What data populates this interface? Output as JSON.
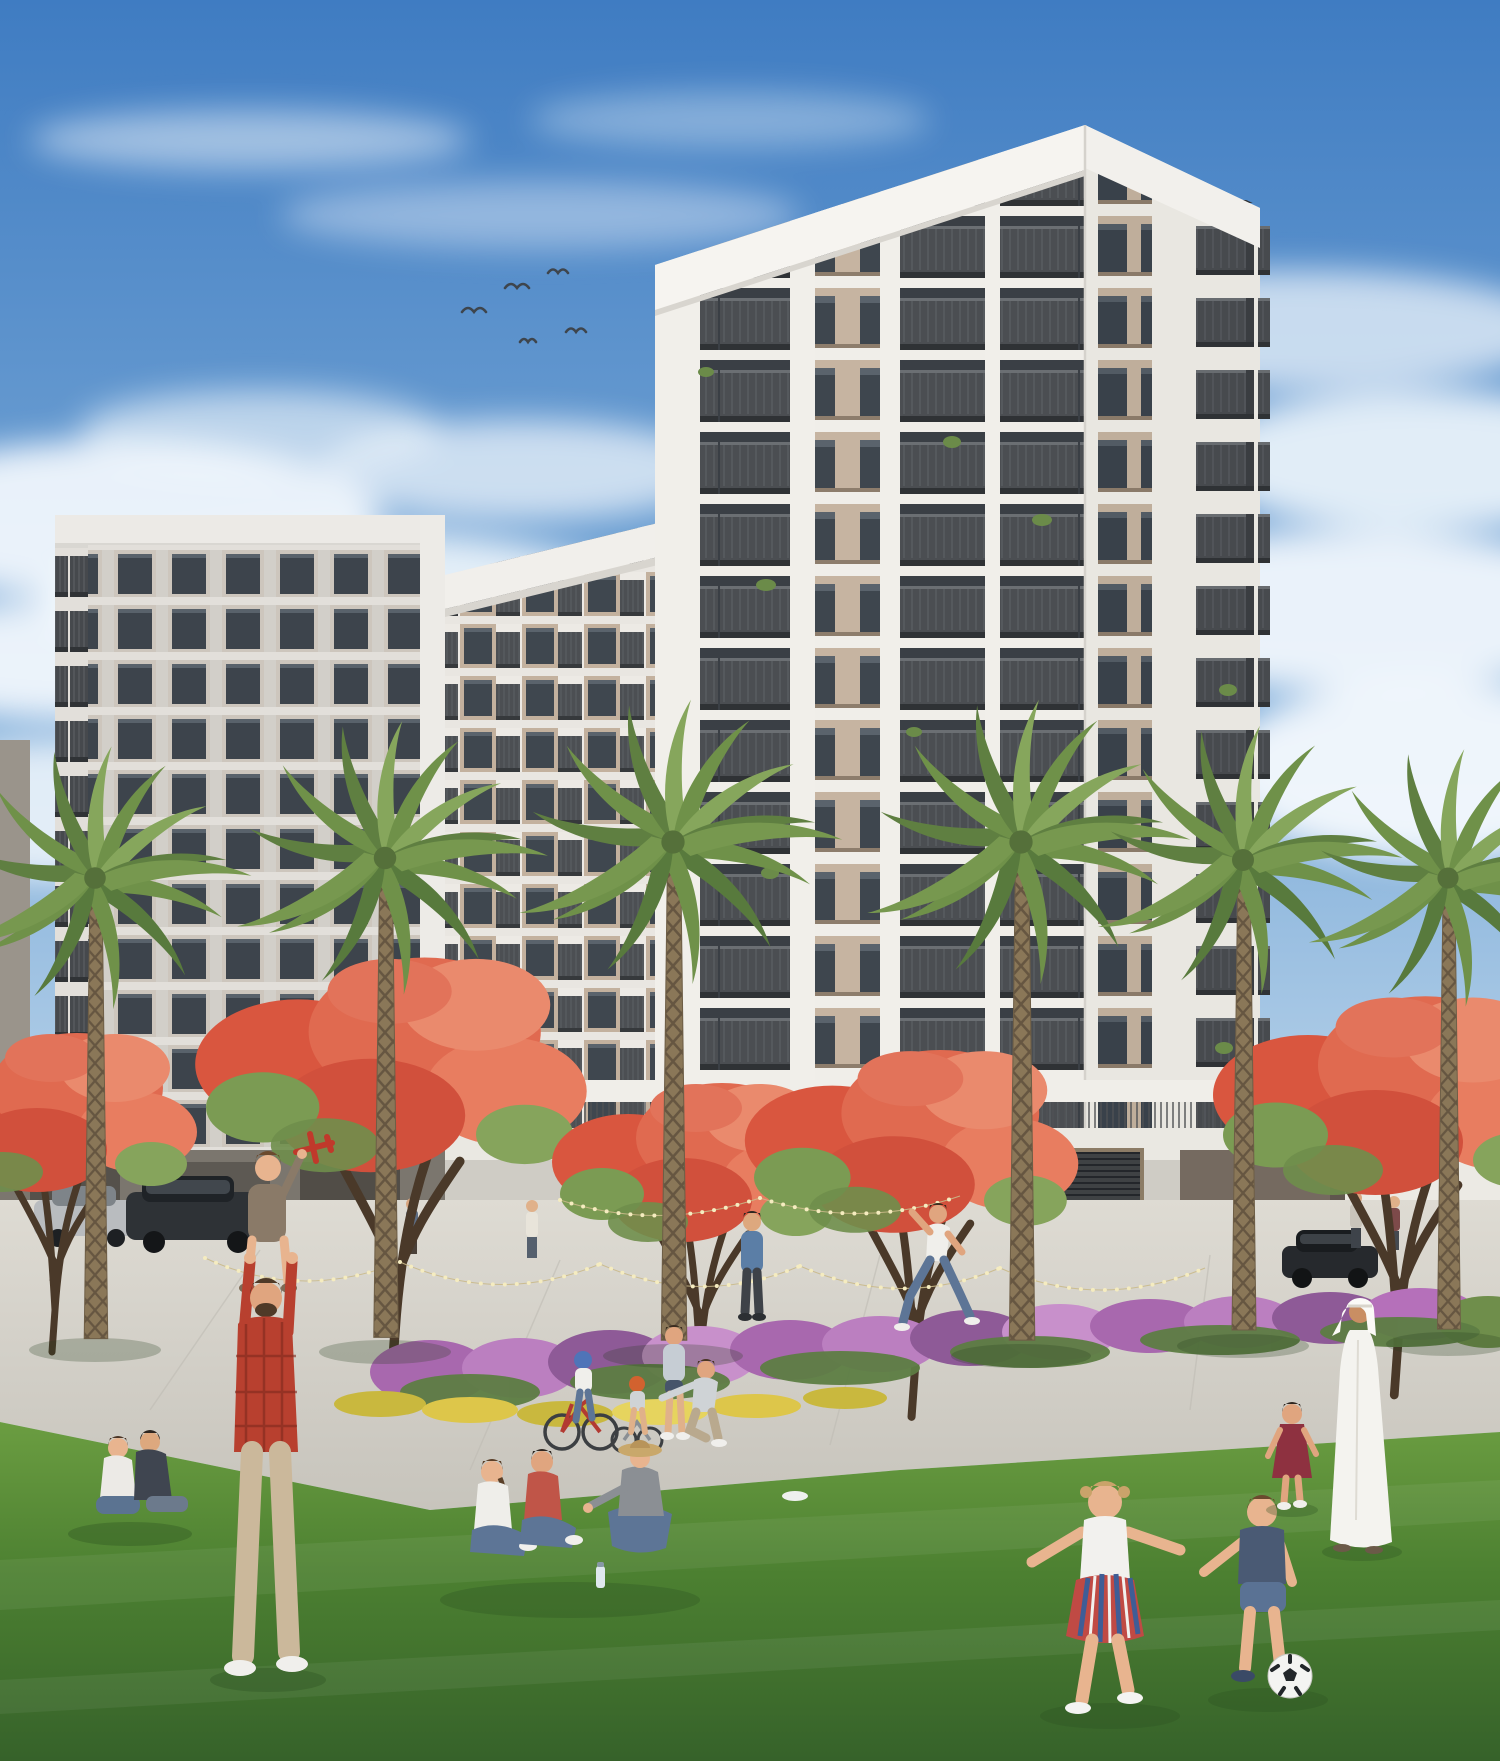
{
  "scene": {
    "type": "architectural-exterior-rendering",
    "subject": "White residential apartment complex with landscaped park promenade on a sunny day",
    "signs": {
      "building_name": "HAYA",
      "storefront_sign": "THE ART OF PIZZA"
    },
    "buildings": {
      "main_tower": "14-storey white corner tower with beige window strips and stacked dark grey balconies",
      "mid_wing": "lower connected wing with repeating balcony bays",
      "left_block": "grey mid-rise apartment block with balconies",
      "podium": "ground-floor retail with glass storefronts, string lights, louvre vent and bronze entrance portal"
    },
    "landscape": {
      "palm_trees": 6,
      "flame_trees": 5,
      "hedge": "purple bougainvillea hedge with yellow flower beds",
      "lawn": "large green foreground lawn",
      "walkway": "light concrete promenade"
    },
    "people": [
      {
        "name": "sitting-couple",
        "desc": "couple seated on the grass at far left"
      },
      {
        "name": "father-and-child",
        "desc": "father in red plaid shirt carrying a boy on his shoulders; the boy holds up a red toy plane"
      },
      {
        "name": "bike-family",
        "desc": "parents with two children on bicycles wearing blue and orange helmets"
      },
      {
        "name": "picnic-trio",
        "desc": "three women sitting together on the lawn, one wearing a sun hat, water bottle beside them"
      },
      {
        "name": "standing-man",
        "desc": "man in a blue shirt standing on the walkway"
      },
      {
        "name": "running-man",
        "desc": "man in white t-shirt and jeans playing on the lawn"
      },
      {
        "name": "soccer-kids",
        "desc": "girl in striped skirt and toddler boy chasing a black-and-white soccer ball"
      },
      {
        "name": "girl-in-red-dress",
        "desc": "small girl in a dark red dress"
      },
      {
        "name": "man-in-kandura",
        "desc": "man in traditional white kandura and ghutra walking at right"
      },
      {
        "name": "background-pedestrians",
        "desc": "small figures walking near the storefronts"
      }
    ],
    "vehicles": "dark SUV and silver car parked at far left, dark car at right entrance drive",
    "wildlife": "small flock of birds in the sky, upper left of the tower",
    "sky": "blue sky, deeper at top left, with soft white clouds",
    "colors": {
      "sky_top": "#3d7ac1",
      "sky_horizon": "#e8f0f6",
      "cloud": "#f7fbfe",
      "facade_white": "#f1efea",
      "facade_beige": "#c6b4a1",
      "balcony_dark": "#4a4d51",
      "window_glass": "#3d444c",
      "portal_bronze": "#756a60",
      "flame_blossom": "#e0604c",
      "bougainvillea": "#b570ba",
      "flower_yellow": "#ddc64a",
      "palm_green": "#6f9149",
      "grass_green": "#4c8031",
      "walkway": "#d8d5cc"
    }
  }
}
